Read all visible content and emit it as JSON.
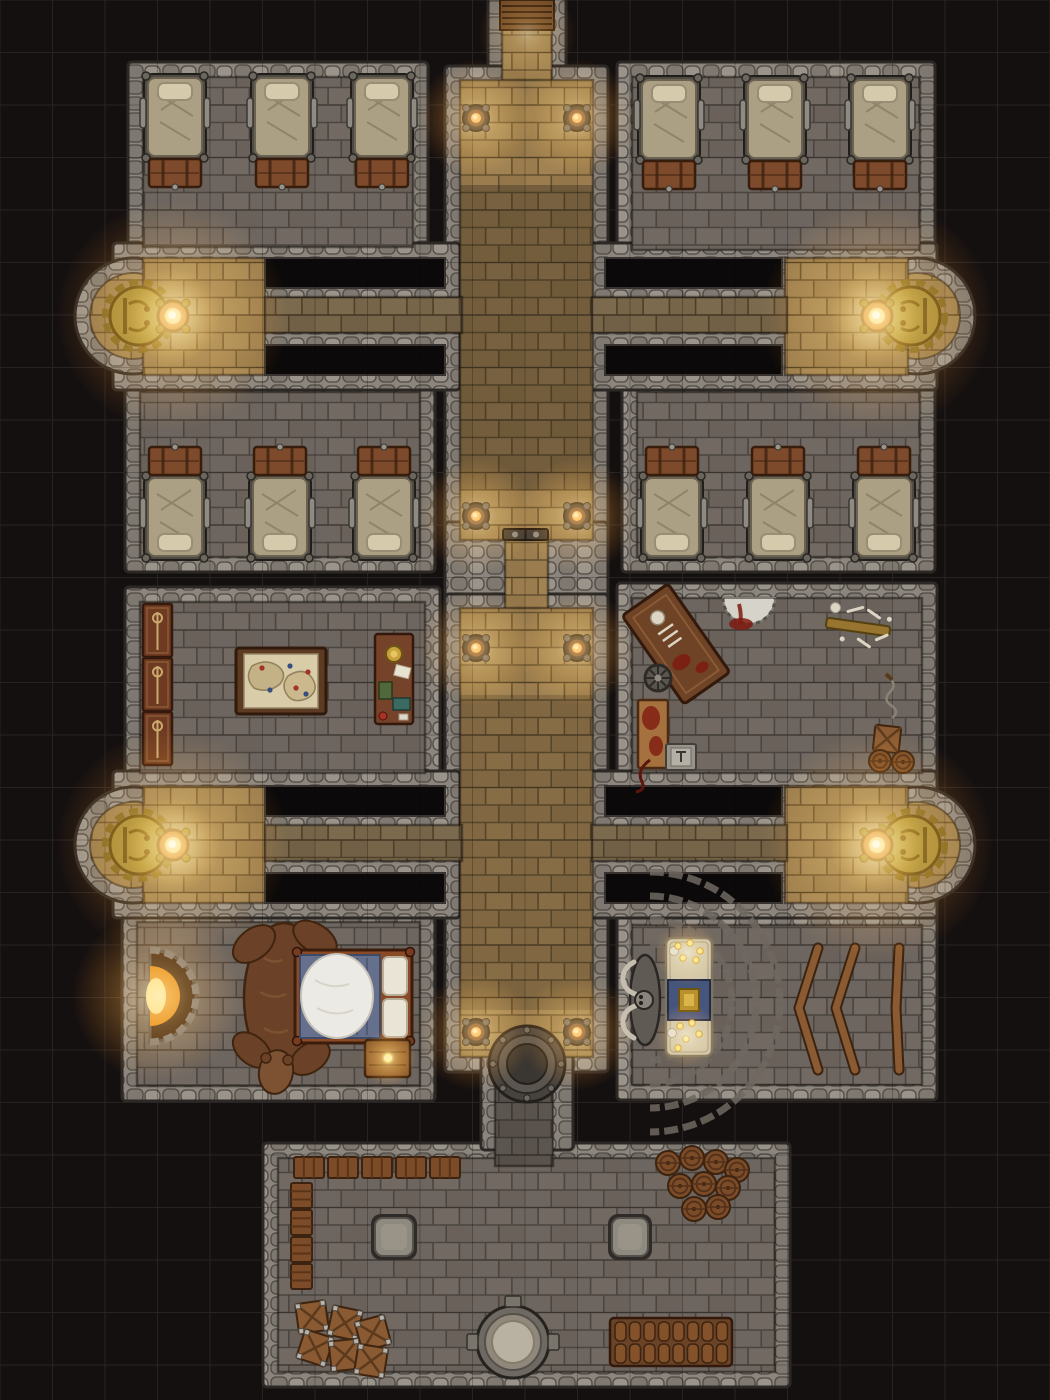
{
  "scene": {
    "width": 1050,
    "height": 1400,
    "bg": "#151010",
    "grid": {
      "size": 52.5,
      "color": "#292222",
      "overlay": "rgba(12,9,7,0.26)"
    },
    "palette": {
      "wall_fill": "#8b857d",
      "wall_stone_light": "#99938a",
      "wall_stone_dark": "#7e7870",
      "wall_stroke": "#2c2825",
      "gray_floor": "#6d655f",
      "gray_mortar": "#4b443f",
      "tan_floor": "#9a7c4e",
      "tan_mortar": "#64502f",
      "tandim_floor": "#77654a",
      "tandim_mortar": "#4e3f28",
      "void_fill": "#0b0909",
      "void_stroke": "#383330",
      "glow_core": "#ffe6ae",
      "glow_mid": "#ffae45",
      "glow_edge": "#ff8400",
      "wood_dark": "#5d3a22",
      "wood_mid": "#7d4a2b",
      "wood_light": "#a4713f",
      "parchment": "#d9cda9",
      "blood": "#7e1b10",
      "bone": "#ddd5c4",
      "gold": "#9d8133",
      "flame": "#ff9f35",
      "mattress": "#aba083",
      "pillow": "#d6caac",
      "blanket_blue": "#64708c",
      "fur_white": "#eceae4",
      "stone_table": "#8f8a80",
      "altar_stone": "#cfc5a8"
    }
  },
  "layers": {
    "wall_blocks": [
      {
        "x": 128,
        "y": 62,
        "w": 300,
        "h": 200,
        "name": "barracks-nw-walls"
      },
      {
        "x": 617,
        "y": 62,
        "w": 318,
        "h": 203,
        "name": "barracks-ne-walls"
      },
      {
        "x": 125,
        "y": 377,
        "w": 310,
        "h": 195,
        "name": "barracks-w-walls"
      },
      {
        "x": 622,
        "y": 377,
        "w": 313,
        "h": 195,
        "name": "barracks-e-walls"
      },
      {
        "x": 125,
        "y": 587,
        "w": 315,
        "h": 201,
        "name": "war-room-walls"
      },
      {
        "x": 617,
        "y": 583,
        "w": 320,
        "h": 205,
        "name": "torture-room-walls"
      },
      {
        "x": 122,
        "y": 907,
        "w": 313,
        "h": 194,
        "name": "bedroom-walls"
      },
      {
        "x": 617,
        "y": 910,
        "w": 320,
        "h": 190,
        "name": "shrine-walls"
      },
      {
        "x": 263,
        "y": 1143,
        "w": 527,
        "h": 244,
        "name": "cellar-walls"
      },
      {
        "x": 488,
        "y": -6,
        "w": 78,
        "h": 96,
        "name": "entry-walls"
      },
      {
        "x": 445,
        "y": 66,
        "w": 163,
        "h": 489,
        "name": "corridor-upper-walls"
      },
      {
        "x": 445,
        "y": 522,
        "w": 163,
        "h": 100,
        "name": "corridor-door-walls"
      },
      {
        "x": 445,
        "y": 594,
        "w": 163,
        "h": 478,
        "name": "corridor-lower-walls"
      },
      {
        "x": 481,
        "y": 1050,
        "w": 92,
        "h": 100,
        "name": "cellar-passage-walls"
      },
      {
        "x": 113,
        "y": 243,
        "w": 347,
        "h": 147,
        "name": "nw-arm-walls"
      },
      {
        "x": 590,
        "y": 243,
        "w": 347,
        "h": 147,
        "name": "ne-arm-walls"
      },
      {
        "x": 113,
        "y": 771,
        "w": 347,
        "h": 147,
        "name": "sw-arm-walls"
      },
      {
        "x": 590,
        "y": 771,
        "w": 347,
        "h": 147,
        "name": "se-arm-walls"
      }
    ],
    "apse_walls": [
      {
        "cx": 133,
        "cy": 316,
        "r": 58
      },
      {
        "cx": 917,
        "cy": 316,
        "r": 58
      },
      {
        "cx": 133,
        "cy": 845,
        "r": 58
      },
      {
        "cx": 917,
        "cy": 845,
        "r": 58
      }
    ],
    "floors": [
      {
        "t": "gray",
        "x": 143,
        "y": 77,
        "w": 270,
        "h": 170,
        "name": "barracks-nw-floor"
      },
      {
        "t": "gray",
        "x": 632,
        "y": 77,
        "w": 288,
        "h": 173,
        "name": "barracks-ne-floor"
      },
      {
        "t": "gray",
        "x": 140,
        "y": 392,
        "w": 280,
        "h": 165,
        "name": "barracks-w-floor"
      },
      {
        "t": "gray",
        "x": 637,
        "y": 392,
        "w": 283,
        "h": 165,
        "name": "barracks-e-floor"
      },
      {
        "t": "gray",
        "x": 140,
        "y": 602,
        "w": 285,
        "h": 171,
        "name": "war-room-floor"
      },
      {
        "t": "gray",
        "x": 632,
        "y": 598,
        "w": 290,
        "h": 175,
        "name": "torture-room-floor"
      },
      {
        "t": "gray",
        "x": 137,
        "y": 922,
        "w": 283,
        "h": 164,
        "name": "bedroom-floor"
      },
      {
        "t": "gray",
        "x": 632,
        "y": 925,
        "w": 290,
        "h": 160,
        "name": "shrine-floor"
      },
      {
        "t": "gray",
        "x": 278,
        "y": 1158,
        "w": 497,
        "h": 214,
        "name": "cellar-floor"
      },
      {
        "t": "gray",
        "x": 495,
        "y": 1078,
        "w": 58,
        "h": 88,
        "name": "cellar-passage-floor"
      },
      {
        "t": "tan",
        "x": 502,
        "y": 6,
        "w": 50,
        "h": 80,
        "name": "entry-corridor-floor"
      },
      {
        "t": "tan",
        "x": 460,
        "y": 80,
        "w": 133,
        "h": 460,
        "name": "main-corridor-upper-floor"
      },
      {
        "t": "tan",
        "x": 505,
        "y": 535,
        "w": 43,
        "h": 77,
        "name": "corridor-door-passage-floor"
      },
      {
        "t": "tan",
        "x": 460,
        "y": 608,
        "w": 133,
        "h": 449,
        "name": "main-corridor-lower-floor"
      },
      {
        "t": "tan",
        "x": 143,
        "y": 258,
        "w": 122,
        "h": 117,
        "name": "nw-brazier-chamber-floor"
      },
      {
        "t": "tan",
        "x": 785,
        "y": 258,
        "w": 123,
        "h": 117,
        "name": "ne-brazier-chamber-floor"
      },
      {
        "t": "tan",
        "x": 143,
        "y": 786,
        "w": 122,
        "h": 117,
        "name": "sw-brazier-chamber-floor"
      },
      {
        "t": "tan",
        "x": 785,
        "y": 786,
        "w": 123,
        "h": 117,
        "name": "se-brazier-chamber-floor"
      },
      {
        "t": "tandim",
        "x": 265,
        "y": 297,
        "w": 197,
        "h": 36,
        "name": "nw-connector-floor"
      },
      {
        "t": "tandim",
        "x": 592,
        "y": 297,
        "w": 195,
        "h": 36,
        "name": "ne-connector-floor"
      },
      {
        "t": "tandim",
        "x": 265,
        "y": 825,
        "w": 197,
        "h": 36,
        "name": "sw-connector-floor"
      },
      {
        "t": "tandim",
        "x": 592,
        "y": 825,
        "w": 195,
        "h": 36,
        "name": "se-connector-floor"
      }
    ],
    "floor_circles": [
      {
        "cx": 133,
        "cy": 316,
        "r": 43
      },
      {
        "cx": 917,
        "cy": 316,
        "r": 43
      },
      {
        "cx": 133,
        "cy": 845,
        "r": 43
      },
      {
        "cx": 917,
        "cy": 845,
        "r": 43
      }
    ],
    "voids": [
      {
        "x": 265,
        "y": 258,
        "w": 180,
        "h": 30
      },
      {
        "x": 265,
        "y": 345,
        "w": 180,
        "h": 30
      },
      {
        "x": 605,
        "y": 258,
        "w": 177,
        "h": 30
      },
      {
        "x": 605,
        "y": 345,
        "w": 177,
        "h": 30
      },
      {
        "x": 265,
        "y": 786,
        "w": 180,
        "h": 30
      },
      {
        "x": 265,
        "y": 873,
        "w": 180,
        "h": 30
      },
      {
        "x": 605,
        "y": 786,
        "w": 177,
        "h": 30
      },
      {
        "x": 605,
        "y": 873,
        "w": 177,
        "h": 30
      }
    ],
    "shades": [
      {
        "x": 460,
        "y": 185,
        "w": 133,
        "h": 305,
        "c": "rgba(28,24,20,0.30)"
      },
      {
        "x": 460,
        "y": 695,
        "w": 133,
        "h": 315,
        "c": "rgba(28,24,20,0.20)"
      },
      {
        "x": 495,
        "y": 1078,
        "w": 58,
        "h": 88,
        "c": "rgba(0,0,0,0.18)"
      }
    ],
    "stairs": {
      "x": 500,
      "y": 0,
      "w": 54,
      "h": 30,
      "steps": 4
    },
    "door": {
      "x": 503,
      "y": 529,
      "w": 45,
      "h": 11
    },
    "basin": {
      "cx": 527,
      "cy": 1064,
      "r": 38
    },
    "sconces": [
      {
        "x": 476,
        "y": 118
      },
      {
        "x": 577,
        "y": 118
      },
      {
        "x": 476,
        "y": 516
      },
      {
        "x": 577,
        "y": 516
      },
      {
        "x": 476,
        "y": 648
      },
      {
        "x": 577,
        "y": 648
      },
      {
        "x": 476,
        "y": 1032
      },
      {
        "x": 577,
        "y": 1032
      }
    ],
    "braziers": [
      {
        "cx": 133,
        "cy": 316,
        "face": 1
      },
      {
        "cx": 917,
        "cy": 316,
        "face": -1
      },
      {
        "cx": 133,
        "cy": 845,
        "face": 1
      },
      {
        "cx": 917,
        "cy": 845,
        "face": -1
      }
    ],
    "beds": [
      {
        "cx": 175,
        "y": 78,
        "o": "pt"
      },
      {
        "cx": 282,
        "y": 78,
        "o": "pt"
      },
      {
        "cx": 382,
        "y": 78,
        "o": "pt"
      },
      {
        "cx": 669,
        "y": 80,
        "o": "pt"
      },
      {
        "cx": 775,
        "y": 80,
        "o": "pt"
      },
      {
        "cx": 880,
        "y": 80,
        "o": "pt"
      },
      {
        "cx": 175,
        "y": 447,
        "o": "pb"
      },
      {
        "cx": 280,
        "y": 447,
        "o": "pb"
      },
      {
        "cx": 384,
        "y": 447,
        "o": "pb"
      },
      {
        "cx": 672,
        "y": 447,
        "o": "pb"
      },
      {
        "cx": 778,
        "y": 447,
        "o": "pb"
      },
      {
        "cx": 884,
        "y": 447,
        "o": "pb"
      }
    ],
    "furniture": [
      {
        "type": "cabinet",
        "x": 143,
        "y": 604
      },
      {
        "type": "cabinet",
        "x": 143,
        "y": 658
      },
      {
        "type": "cabinet",
        "x": 143,
        "y": 712
      },
      {
        "type": "map-table",
        "x": 236,
        "y": 648
      },
      {
        "type": "desk",
        "x": 375,
        "y": 634
      },
      {
        "type": "torture-table",
        "cx": 676,
        "cy": 644,
        "rot": -35
      },
      {
        "type": "spiked-wheel",
        "cx": 658,
        "cy": 678
      },
      {
        "type": "wall-saw",
        "cx": 749,
        "cy": 598
      },
      {
        "type": "bone-rack",
        "cx": 858,
        "cy": 627,
        "rot": 8
      },
      {
        "type": "whip",
        "x": 888,
        "y": 678
      },
      {
        "type": "blood-table",
        "x": 638,
        "y": 700
      },
      {
        "type": "tool-tray",
        "x": 666,
        "y": 744
      },
      {
        "type": "crate",
        "x": 874,
        "y": 726,
        "s": 26,
        "rot": 6,
        "steel": false
      },
      {
        "type": "barrel",
        "cx": 880,
        "cy": 761,
        "r": 11
      },
      {
        "type": "barrel",
        "cx": 903,
        "cy": 762,
        "r": 11
      },
      {
        "type": "fireplace",
        "cx": 150,
        "cy": 996
      },
      {
        "type": "bear-rug",
        "cx": 284,
        "cy": 998
      },
      {
        "type": "double-bed",
        "x": 295,
        "y": 950
      },
      {
        "type": "nightstand",
        "x": 365,
        "y": 1040
      },
      {
        "type": "shrine-arcs",
        "cx": 650,
        "cy": 1002
      },
      {
        "type": "shrine-statue",
        "cx": 645,
        "cy": 1000
      },
      {
        "type": "altar",
        "x": 666,
        "y": 938
      },
      {
        "type": "bench",
        "pts": [
          [
            818,
            948
          ],
          [
            799,
            1008
          ],
          [
            818,
            1070
          ]
        ]
      },
      {
        "type": "bench",
        "pts": [
          [
            855,
            948
          ],
          [
            836,
            1008
          ],
          [
            855,
            1070
          ]
        ]
      },
      {
        "type": "bench",
        "pts": [
          [
            899,
            948
          ],
          [
            896,
            1008
          ],
          [
            899,
            1070
          ]
        ]
      },
      {
        "type": "crate-slat",
        "x": 294,
        "y": 1157,
        "w": 30,
        "h": 21
      },
      {
        "type": "crate-slat",
        "x": 328,
        "y": 1157,
        "w": 30,
        "h": 21
      },
      {
        "type": "crate-slat",
        "x": 362,
        "y": 1157,
        "w": 30,
        "h": 21
      },
      {
        "type": "crate-slat",
        "x": 396,
        "y": 1157,
        "w": 30,
        "h": 21
      },
      {
        "type": "crate-slat",
        "x": 430,
        "y": 1157,
        "w": 30,
        "h": 21
      },
      {
        "type": "crate-slat",
        "x": 291,
        "y": 1183,
        "w": 21,
        "h": 25
      },
      {
        "type": "crate-slat",
        "x": 291,
        "y": 1210,
        "w": 21,
        "h": 25
      },
      {
        "type": "crate-slat",
        "x": 291,
        "y": 1237,
        "w": 21,
        "h": 25
      },
      {
        "type": "crate-slat",
        "x": 291,
        "y": 1264,
        "w": 21,
        "h": 25
      },
      {
        "type": "stone-table",
        "x": 371,
        "y": 1214,
        "w": 46,
        "h": 46
      },
      {
        "type": "stone-table",
        "x": 608,
        "y": 1214,
        "w": 44,
        "h": 46
      },
      {
        "type": "barrel",
        "cx": 668,
        "cy": 1163,
        "r": 12
      },
      {
        "type": "barrel",
        "cx": 692,
        "cy": 1158,
        "r": 12
      },
      {
        "type": "barrel",
        "cx": 716,
        "cy": 1162,
        "r": 12
      },
      {
        "type": "barrel",
        "cx": 737,
        "cy": 1170,
        "r": 12
      },
      {
        "type": "barrel",
        "cx": 680,
        "cy": 1186,
        "r": 12
      },
      {
        "type": "barrel",
        "cx": 704,
        "cy": 1184,
        "r": 12
      },
      {
        "type": "barrel",
        "cx": 728,
        "cy": 1188,
        "r": 12
      },
      {
        "type": "barrel",
        "cx": 694,
        "cy": 1209,
        "r": 12
      },
      {
        "type": "barrel",
        "cx": 718,
        "cy": 1207,
        "r": 12
      },
      {
        "type": "keg-rack",
        "x": 610,
        "y": 1318
      },
      {
        "type": "well",
        "cx": 513,
        "cy": 1342
      },
      {
        "type": "crate",
        "x": 297,
        "y": 1302,
        "s": 30,
        "rot": -8,
        "steel": true
      },
      {
        "type": "crate",
        "x": 330,
        "y": 1308,
        "s": 30,
        "rot": 12,
        "steel": true
      },
      {
        "type": "crate",
        "x": 358,
        "y": 1318,
        "s": 30,
        "rot": -15,
        "steel": true
      },
      {
        "type": "crate",
        "x": 300,
        "y": 1333,
        "s": 30,
        "rot": 18,
        "steel": true
      },
      {
        "type": "crate",
        "x": 330,
        "y": 1340,
        "s": 30,
        "rot": -6,
        "steel": true
      },
      {
        "type": "crate",
        "x": 356,
        "y": 1346,
        "s": 30,
        "rot": 9,
        "steel": true
      }
    ],
    "extra_lights": [
      {
        "x": 527,
        "y": 34,
        "r": 48,
        "o": 0.4
      },
      {
        "x": 158,
        "y": 996,
        "r": 85,
        "o": 0.65
      },
      {
        "x": 388,
        "y": 1058,
        "r": 28,
        "o": 0.85
      },
      {
        "x": 687,
        "y": 953,
        "r": 32,
        "o": 0.6
      },
      {
        "x": 687,
        "y": 1036,
        "r": 32,
        "o": 0.6
      }
    ]
  }
}
